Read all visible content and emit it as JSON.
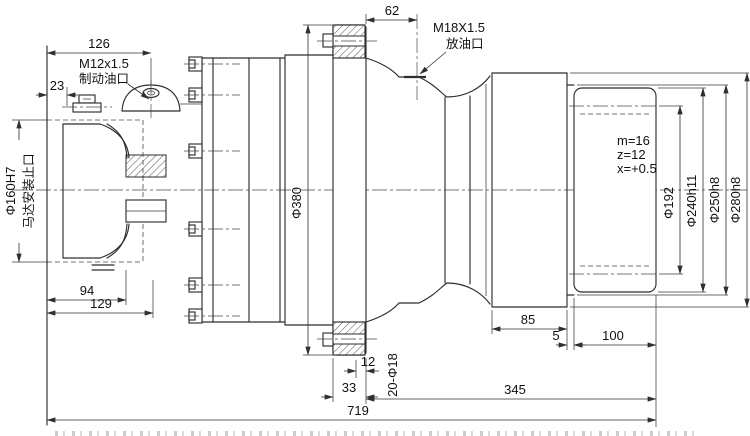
{
  "drawing": {
    "type": "engineering-section-drawing",
    "dims": {
      "d126": "126",
      "d23": "23",
      "d94": "94",
      "d129": "129",
      "d62": "62",
      "d85": "85",
      "d5": "5",
      "d100": "100",
      "d12": "12",
      "d33": "33",
      "d345": "345",
      "d719": "719"
    },
    "labels": {
      "brake_port_thread": "M12x1.5",
      "brake_port_name": "制动油口",
      "drain_port_thread": "M18X1.5",
      "drain_port_name": "放油口",
      "motor_spigot_dia": "Φ160H7",
      "motor_spigot_name": "马达安装止口",
      "flange_dia": "Φ380",
      "gear_module": "m=16",
      "gear_teeth": "z=12",
      "gear_shift": "x=+0.5",
      "pitch_dia": "Φ192",
      "spline_major_dia": "Φ240h11",
      "collar_dia": "Φ250h8",
      "hub_pilot_dia": "Φ280h8",
      "bolt_holes": "20-Φ18"
    },
    "colors": {
      "line": "#2e2e2e",
      "text": "#111111",
      "background": "#ffffff"
    }
  }
}
